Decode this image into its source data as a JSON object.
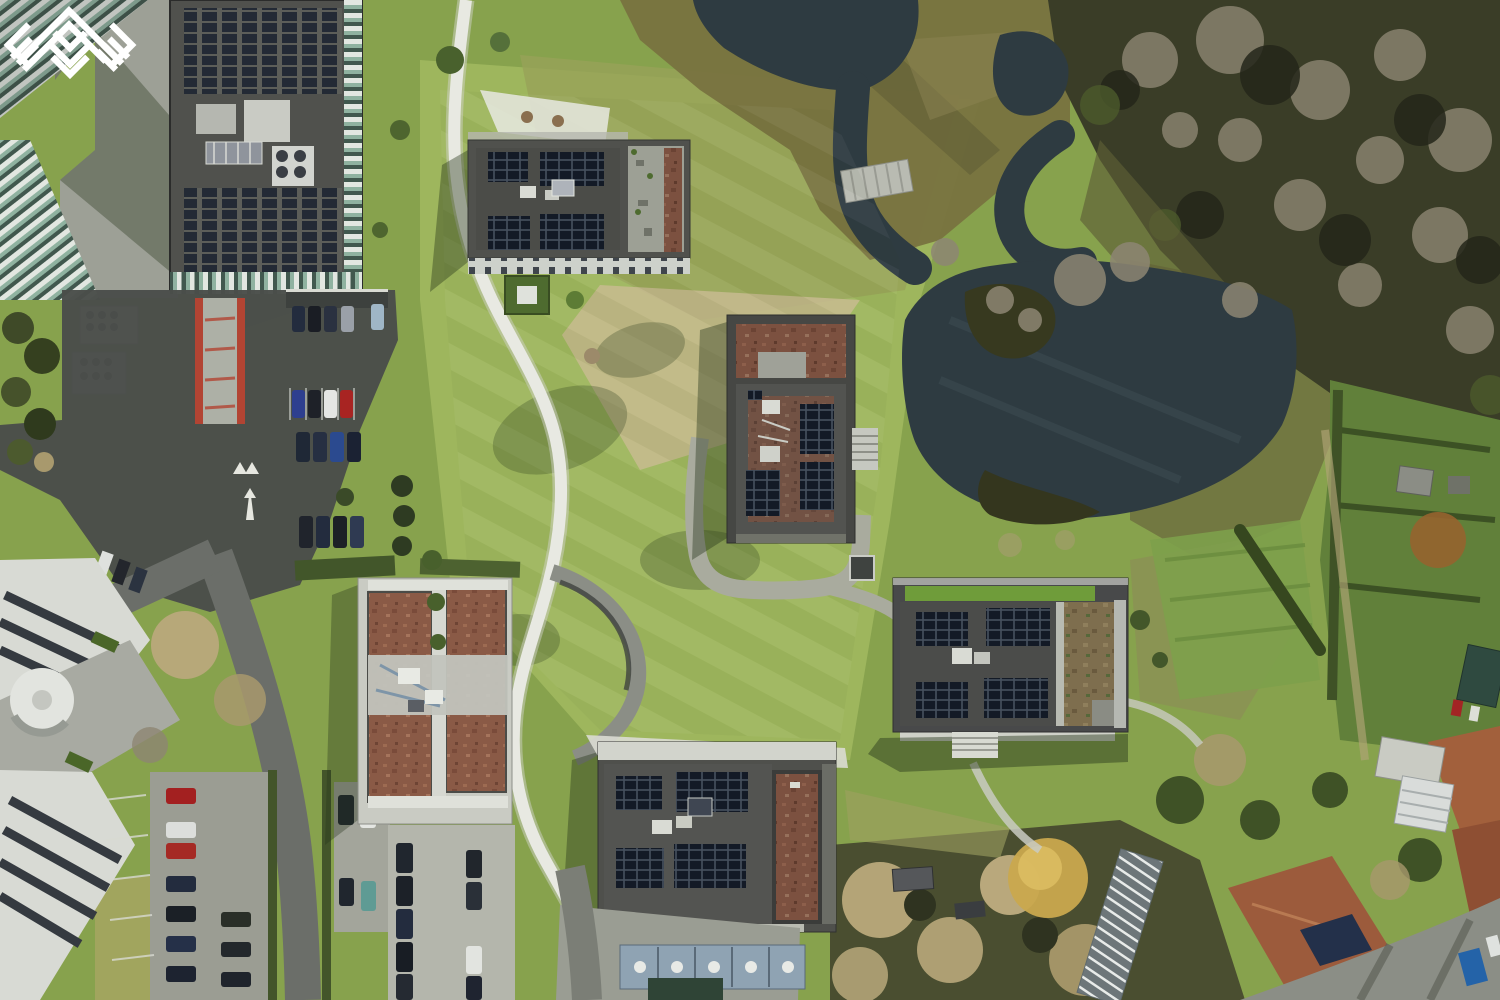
{
  "scene": {
    "type": "aerial-drone-photograph",
    "description": "Top-down winter drone view of a green office campus: five flat-roofed buildings with rooftop solar arrays and red sedum gravel, winding white footpaths across lawns, a dark meandering pond with a small wooden footbridge, a large solar-covered office block with striped green facades and car parking on the west, bare woodland to the north-east, allotment gardens on the east and brick houses with gardens on the south-east.",
    "season": "winter",
    "camera": "nadir top-down"
  },
  "watermark": {
    "icon": "chevron-weave-logo",
    "color": "#ffffff",
    "position": "center-bottom over south building roof"
  },
  "regions": {
    "pond": "meandering retention pond with island shrubs",
    "stream": "narrow stream with wooden footbridge",
    "forest": "bare winter woodland (north-east)",
    "campus": "five campus buildings with rooftop solar panels",
    "office": "large office block with solar roof and green striped facades (north-west)",
    "parking_west": "west staff parking with cars and red ramp",
    "parking_south": "south hedge-lined parking rows",
    "gardens": "allotment gardens with sheds (east)",
    "houses": "residential houses with tiled roofs and greenhouse (south-east)",
    "paths": "white winding footpaths and gray paver loop",
    "marsh": "rough marsh grass between water arms"
  },
  "counts": {
    "campus_buildings": 5
  },
  "palette": {
    "water": "#2e3b41",
    "lawn": "#87a24d",
    "lawn-light": "#a2ba60",
    "lawn-dark": "#5e7b36",
    "path": "#e8e9e2",
    "path-gray": "#a9ab9e",
    "asphalt": "#4a4d4a",
    "concrete": "#9da096",
    "roof": "#50514d",
    "solar": "#141b26",
    "sedum": "#8a5a46",
    "marsh": "#77713f",
    "forest": "#3a3d27",
    "forest-pale": "#8d8673",
    "hedge": "#3c5124",
    "tree-tan": "#b9a97b",
    "tree-gold": "#c9a84e",
    "facade-green": "#8fb2a0",
    "house-roof": "#9c5b3c",
    "watermark": "#ffffff"
  }
}
